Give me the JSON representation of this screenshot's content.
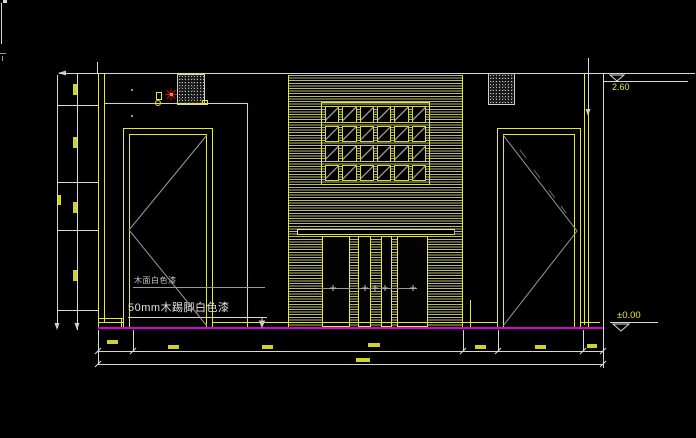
{
  "labels": {
    "finish": "木面白色漆",
    "skirting": "50mm木踢脚白色漆"
  },
  "levels": {
    "top": "2.60",
    "floor": "±0.00"
  },
  "lattice": {
    "rows": 4,
    "cols": 6
  },
  "colors": {
    "line_yellow": "#e8e832",
    "line_white": "#d8d8d8",
    "floor_magenta": "#dd00dd",
    "marker_red": "#c41414",
    "hatch": "#b9b96e"
  }
}
